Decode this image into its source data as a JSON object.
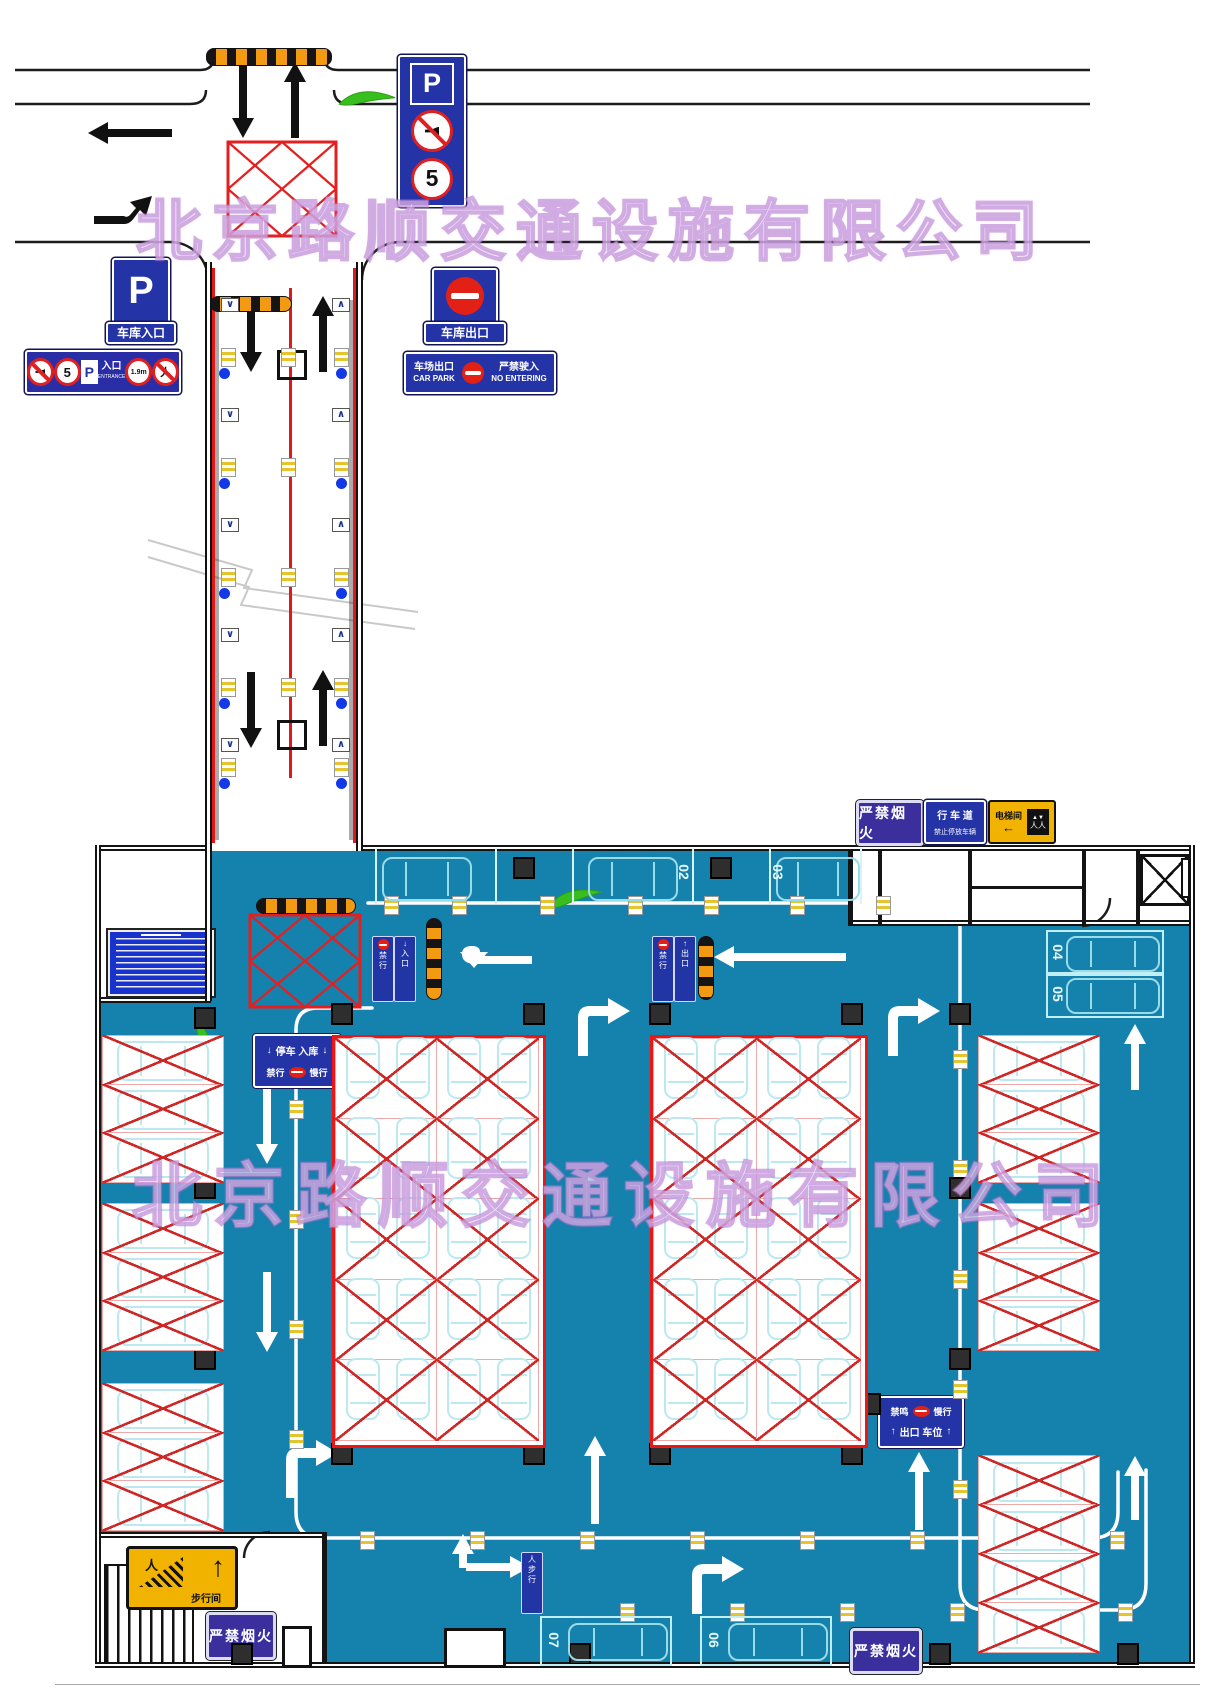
{
  "watermark": {
    "text": "北京路顺交通设施有限公司"
  },
  "top_area": {
    "p_stack": {
      "p": "P",
      "speed": "5"
    },
    "entrance_sign": {
      "p": "P",
      "label": "车库入口"
    },
    "entrance_bar": {
      "speed": "5",
      "p": "P",
      "entry_cn": "入口",
      "entry_en": "ENTRANCE",
      "height_limit": "1.9m"
    },
    "exit_sign": {
      "label": "车库出口"
    },
    "car_park_sign": {
      "cn_left": "车场出口",
      "en_left": "CAR PARK",
      "cn_right": "严禁驶入",
      "en_right": "NO ENTERING"
    }
  },
  "garage": {
    "no_fire": "严禁烟火",
    "lane_sign": {
      "line1": "行 车 道",
      "line2": "禁止停放车辆"
    },
    "elevator_sign": {
      "label": "电梯间",
      "arrow": "←"
    },
    "entry_board": {
      "arrow_left": "↓",
      "text": "停车 入库",
      "arrow_right": "↓",
      "sub_left": "禁行",
      "sub_right": "慢行"
    },
    "exit_board": {
      "top_left": "禁鸣",
      "top_right": "慢行",
      "arrow_left": "↑",
      "text": "出口 车位",
      "arrow_right": "↑"
    },
    "stairs_sign": {
      "label": "步行间"
    },
    "stall_labels": {
      "top_row": [
        "02",
        "03"
      ],
      "right_side": [
        "04",
        "05"
      ],
      "bottom_row": [
        "07",
        "06"
      ]
    },
    "mini_signs": [
      {
        "text": "禁行",
        "icon": "dot"
      },
      {
        "text": "入口",
        "icon": "down"
      },
      {
        "text": "禁行",
        "icon": "dot"
      },
      {
        "text": "出口",
        "icon": "up"
      },
      {
        "text": "步行",
        "icon": "ped"
      }
    ],
    "layout_counts": {
      "left_groups": 3,
      "stalls_per_side_group": 3,
      "block_rows": 5,
      "block_cols": 2,
      "right_bottom_stalls": 4
    }
  },
  "colors": {
    "floor": "#1581ad",
    "sign_blue": "#2433a6",
    "no_entry_red": "#e22016",
    "stall_x_red": "#cf2626",
    "car_cyan": "#9adbe8",
    "warn_yellow": "#f2b200",
    "no_fire_purple": "#3b2f9e",
    "leaf_green": "#38bf1f",
    "bump_orange": "#f29a12"
  }
}
